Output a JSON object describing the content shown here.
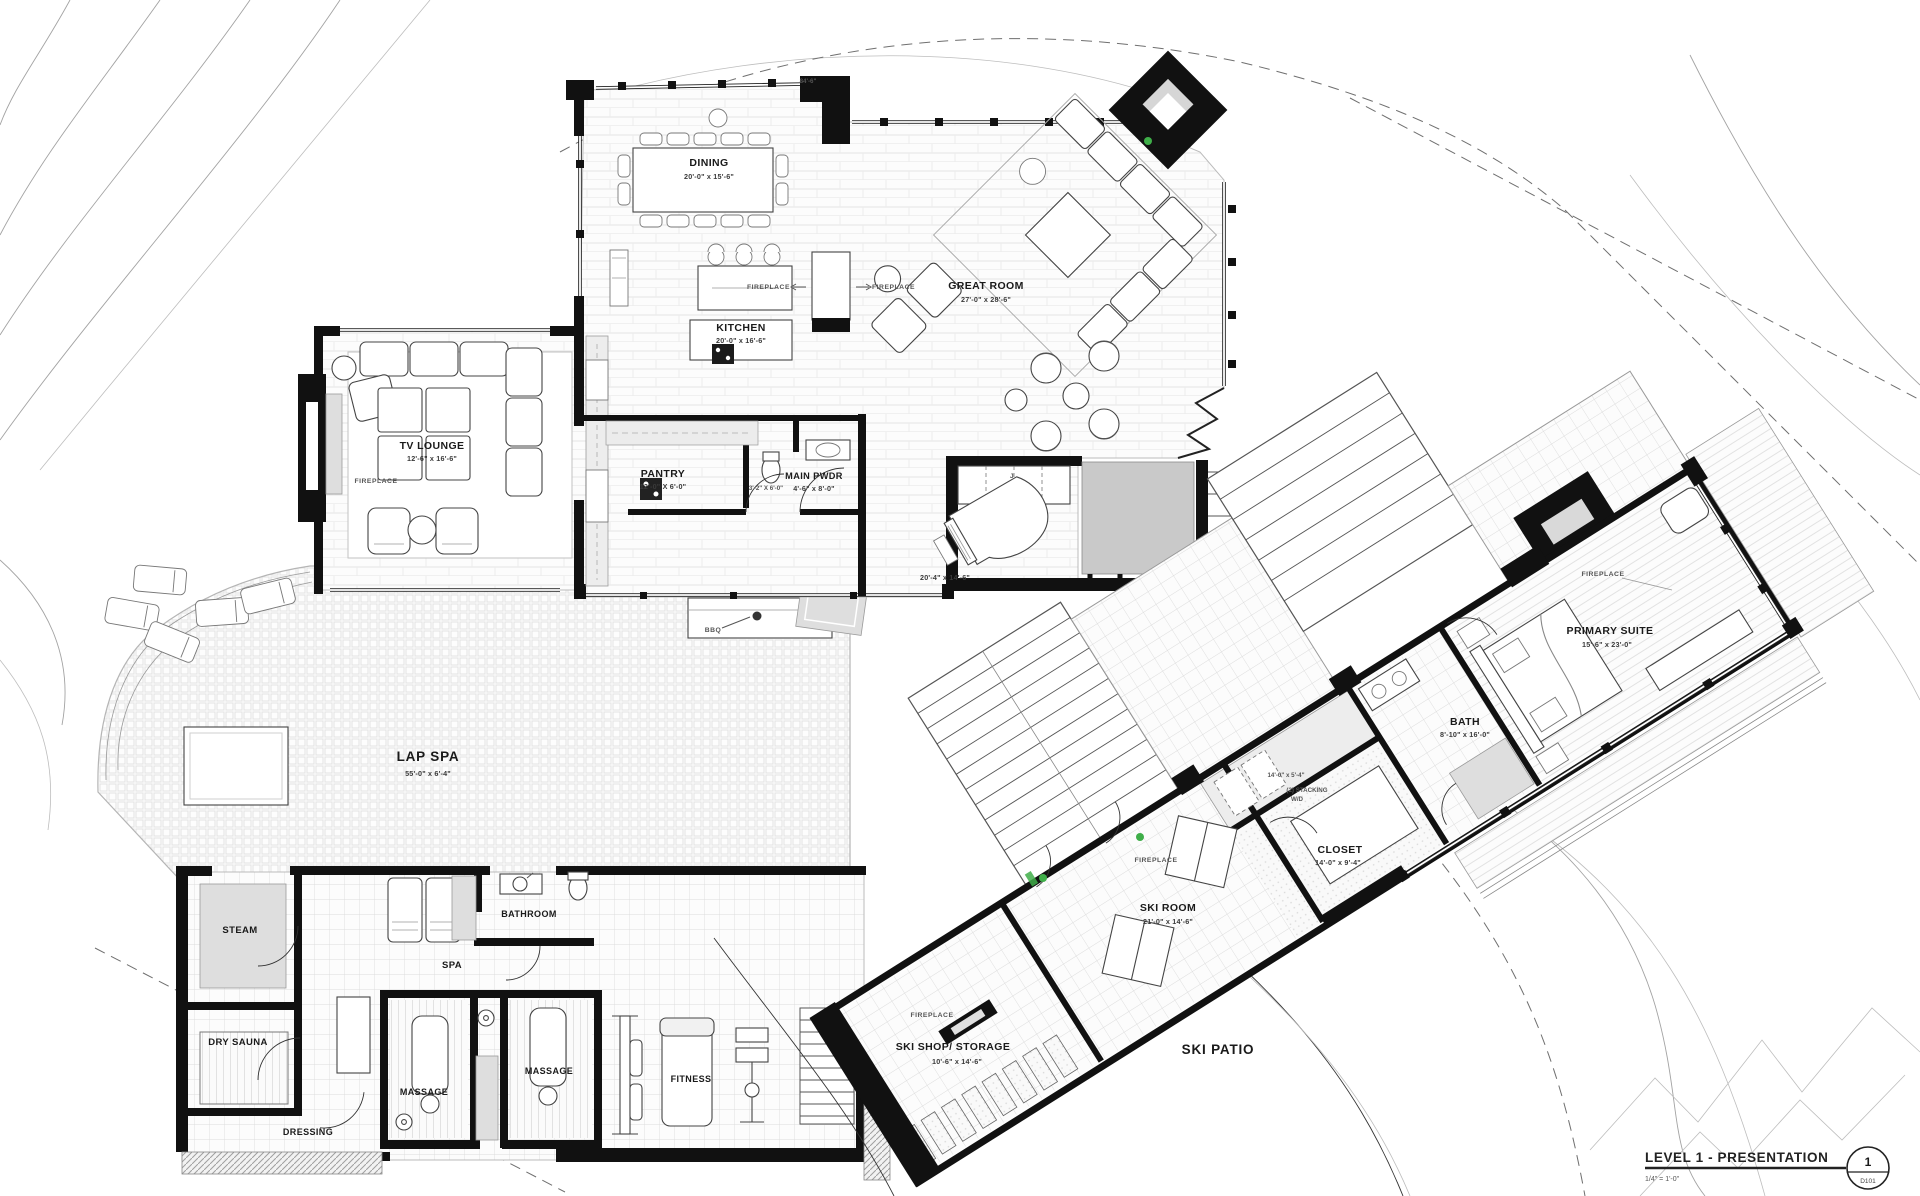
{
  "title_block": {
    "title": "LEVEL 1 - PRESENTATION",
    "scale": "1/4\" = 1'-0\"",
    "sheet_number": "1",
    "sheet_id": "D101"
  },
  "rooms": {
    "dining": {
      "name": "DINING",
      "dims": "20'-0\" x 15'-6\""
    },
    "great_room": {
      "name": "GREAT ROOM",
      "dims": "27'-0\" x 28'-6\""
    },
    "kitchen": {
      "name": "KITCHEN",
      "dims": "20'-0\" x 16'-6\""
    },
    "tv_lounge": {
      "name": "TV LOUNGE",
      "dims": "12'-6\" x 16'-6\""
    },
    "pantry": {
      "name": "PANTRY",
      "dims": "12'-0\" X 6'-0\""
    },
    "wc": {
      "dims": "3'-2\" X 6'-0\""
    },
    "main_pwdr": {
      "name": "MAIN PWDR",
      "dims": "4'-6\" x 8'-0\""
    },
    "lap_spa": {
      "name": "LAP SPA",
      "dims": "55'-0\" x 6'-4\""
    },
    "hall": {
      "dims": "20'-4\" x 14'-6\""
    },
    "steam": {
      "name": "STEAM"
    },
    "dry_sauna": {
      "name": "DRY SAUNA"
    },
    "dressing": {
      "name": "DRESSING"
    },
    "spa": {
      "name": "SPA"
    },
    "bathroom": {
      "name": "BATHROOM"
    },
    "massage_1": {
      "name": "MASSAGE"
    },
    "massage_2": {
      "name": "MASSAGE"
    },
    "fitness": {
      "name": "FITNESS"
    },
    "ski_shop": {
      "name": "SKI SHOP/ STORAGE",
      "dims": "10'-6\" x 14'-6\""
    },
    "ski_patio": {
      "name": "SKI PATIO"
    },
    "ski_room": {
      "name": "SKI ROOM",
      "dims": "21'-0\" x 14'-6\""
    },
    "closet": {
      "name": "CLOSET",
      "dims": "14'-0\" x 9'-4\""
    },
    "laundry": {
      "line1": "(2) STACKING",
      "line2": "W/D",
      "dims": "14'-0\" x 5'-4\""
    },
    "bath": {
      "name": "BATH",
      "dims": "8'-10\" x 16'-0\""
    },
    "primary_suite": {
      "name": "PRIMARY SUITE",
      "dims": "15'-6\" x 23'-0\""
    }
  },
  "annotations": {
    "fireplace": "FIREPLACE",
    "bbq": "BBQ",
    "top_dim": "84'-6\"",
    "mud_tag": "J"
  },
  "colors": {
    "wall": "#111111",
    "floor_pattern": "#e2e2e2",
    "poche_gray": "#c9c9c9",
    "contour_gray": "#a3a3a3",
    "accent_green": "#3fae49"
  }
}
